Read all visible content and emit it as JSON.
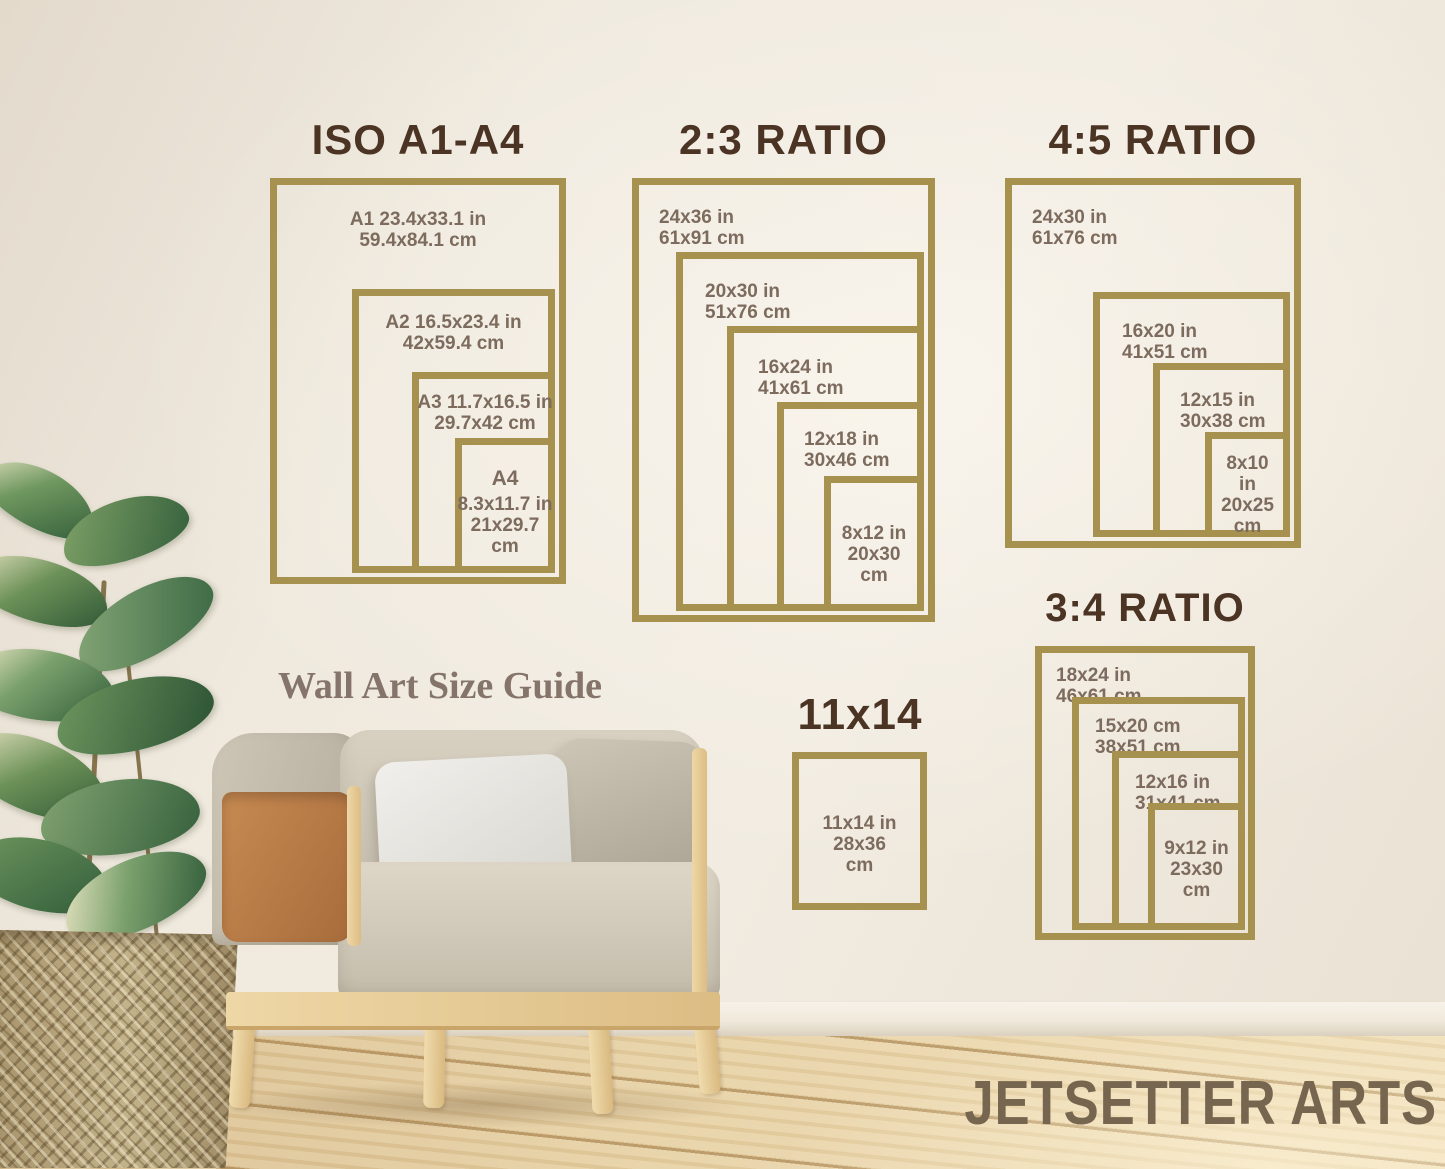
{
  "page": {
    "guide_title": "Wall Art Size Guide",
    "brand": "JETSETTER ARTS"
  },
  "colors": {
    "frame_gold": "#a7914e",
    "title_brown": "#4b3423",
    "label_brown": "#7d6c5e",
    "guide_brown": "#84746a",
    "brand_brown": "#77664f"
  },
  "groups": [
    {
      "id": "iso-a1-a4",
      "title": "ISO A1-A4",
      "frames": [
        {
          "name": "A1",
          "lines": [
            "A1 23.4x33.1 in",
            "59.4x84.1 cm"
          ]
        },
        {
          "name": "A2",
          "lines": [
            "A2 16.5x23.4 in",
            "42x59.4 cm"
          ]
        },
        {
          "name": "A3",
          "lines": [
            "A3 11.7x16.5 in",
            "29.7x42 cm"
          ]
        },
        {
          "name": "A4",
          "lines": [
            "A4",
            "8.3x11.7 in",
            "21x29.7",
            "cm"
          ]
        }
      ]
    },
    {
      "id": "ratio-2-3",
      "title": "2:3 RATIO",
      "frames": [
        {
          "name": "24x36",
          "lines": [
            "24x36 in",
            "61x91 cm"
          ]
        },
        {
          "name": "20x30",
          "lines": [
            "20x30 in",
            "51x76 cm"
          ]
        },
        {
          "name": "16x24",
          "lines": [
            "16x24 in",
            "41x61 cm"
          ]
        },
        {
          "name": "12x18",
          "lines": [
            "12x18 in",
            "30x46 cm"
          ]
        },
        {
          "name": "8x12",
          "lines": [
            "8x12 in",
            "20x30",
            "cm"
          ]
        }
      ]
    },
    {
      "id": "ratio-4-5",
      "title": "4:5 RATIO",
      "frames": [
        {
          "name": "24x30",
          "lines": [
            "24x30 in",
            "61x76 cm"
          ]
        },
        {
          "name": "16x20",
          "lines": [
            "16x20 in",
            "41x51 cm"
          ]
        },
        {
          "name": "12x15",
          "lines": [
            "12x15 in",
            "30x38 cm"
          ]
        },
        {
          "name": "8x10",
          "lines": [
            "8x10 in",
            "20x25",
            "cm"
          ]
        }
      ]
    },
    {
      "id": "ratio-3-4",
      "title": "3:4 RATIO",
      "frames": [
        {
          "name": "18x24",
          "lines": [
            "18x24 in",
            "46x61 cm"
          ]
        },
        {
          "name": "15x20",
          "lines": [
            "15x20 cm",
            "38x51 cm"
          ]
        },
        {
          "name": "12x16",
          "lines": [
            "12x16 in",
            "31x41 cm"
          ]
        },
        {
          "name": "9x12",
          "lines": [
            "9x12 in",
            "23x30",
            "cm"
          ]
        }
      ]
    },
    {
      "id": "size-11x14",
      "title": "11x14",
      "frames": [
        {
          "name": "11x14",
          "lines": [
            "11x14 in",
            "28x36",
            "cm"
          ]
        }
      ]
    }
  ]
}
